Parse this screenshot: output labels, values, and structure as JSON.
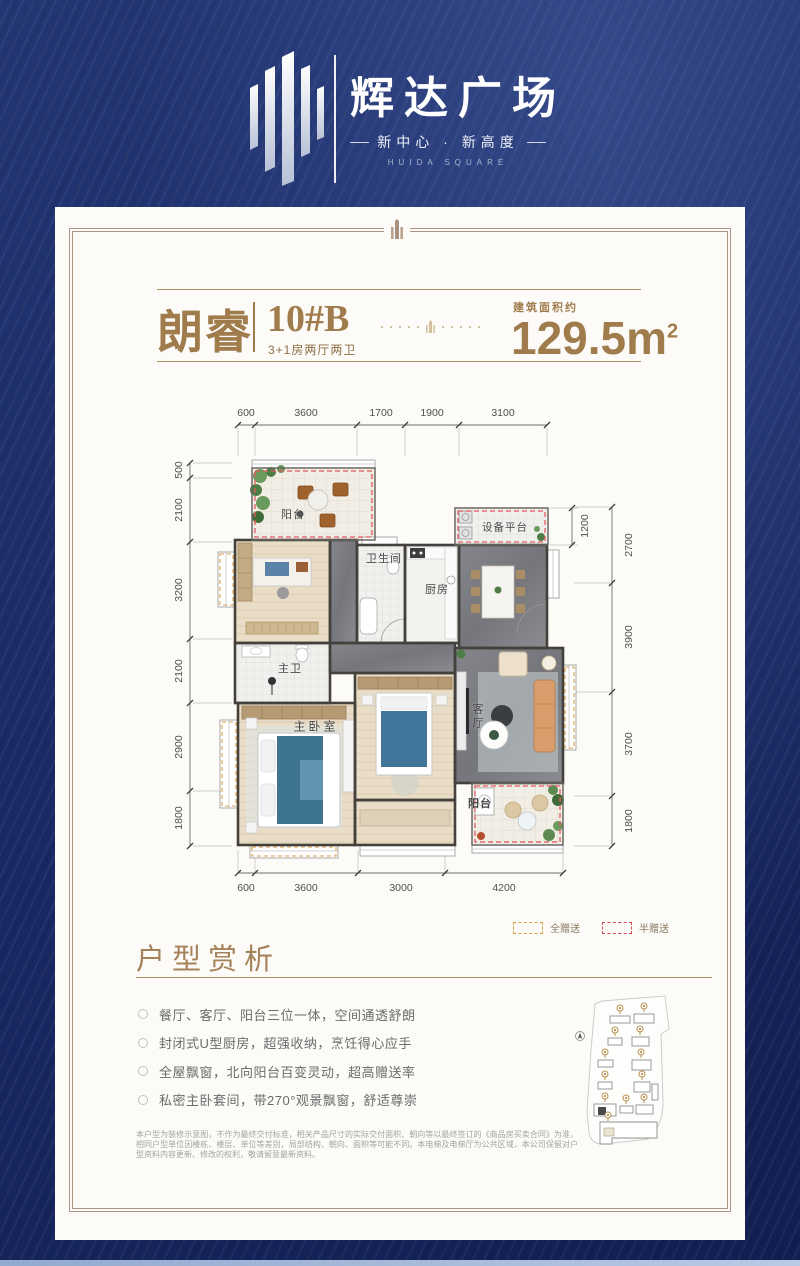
{
  "header": {
    "title": "辉达广场",
    "slogan": "新中心 · 新高度",
    "slogan_en": "HUIDA SQUARE"
  },
  "unit": {
    "name": "朗睿",
    "block": "10#B",
    "layout": "3+1房两厅两卫",
    "area_label": "建筑面积约",
    "area_value": "129.5m",
    "area_exp": "2"
  },
  "floorplan": {
    "dims_top": [
      "600",
      "3600",
      "1700",
      "1900",
      "3100"
    ],
    "dims_left": [
      "500",
      "2100",
      "3200",
      "2100",
      "2900",
      "1800"
    ],
    "dims_right": [
      "2700",
      "3900",
      "3700",
      "1800"
    ],
    "dims_bottom": [
      "600",
      "3600",
      "3000",
      "4200"
    ],
    "dim_equipment": "1200",
    "rooms": {
      "balcony_north": "阳台",
      "equipment_platform": "设备平台",
      "bathroom": "卫生间",
      "kitchen": "厨房",
      "master_bathroom": "主卫",
      "master_bedroom": "主卧室",
      "living_room": "客厅",
      "balcony_south": "阳台"
    }
  },
  "legend": {
    "full_gift": "全赠送",
    "half_gift": "半赠送"
  },
  "analysis": {
    "title": "户型赏析",
    "points": [
      "餐厅、客厅、阳台三位一体，空间通透舒朗",
      "封闭式U型厨房，超强收纳，烹饪得心应手",
      "全屋飘窗，北向阳台百变灵动，超高赠送率",
      "私密主卧套间，带270°观景飘窗，舒适尊崇"
    ]
  },
  "disclaimer": "本户型为装修示意图，不作为最终交付标准，相关产品尺寸的实际交付面积、朝向等以最终签订的《商品房买卖合同》为准，相同户型单位因楼栋、楼层、单位等差别，局部结构、朝向、面积等可能不同。本电梯及电梯厅为公共区域，本公司保留对户型资料内容更新、修改的权利，敬请留意最新资料。",
  "colors": {
    "brand_gold": "#a07c4c",
    "navy": "#1a2a66",
    "gift_full": "#d9a24a",
    "gift_half": "#d0484f"
  }
}
